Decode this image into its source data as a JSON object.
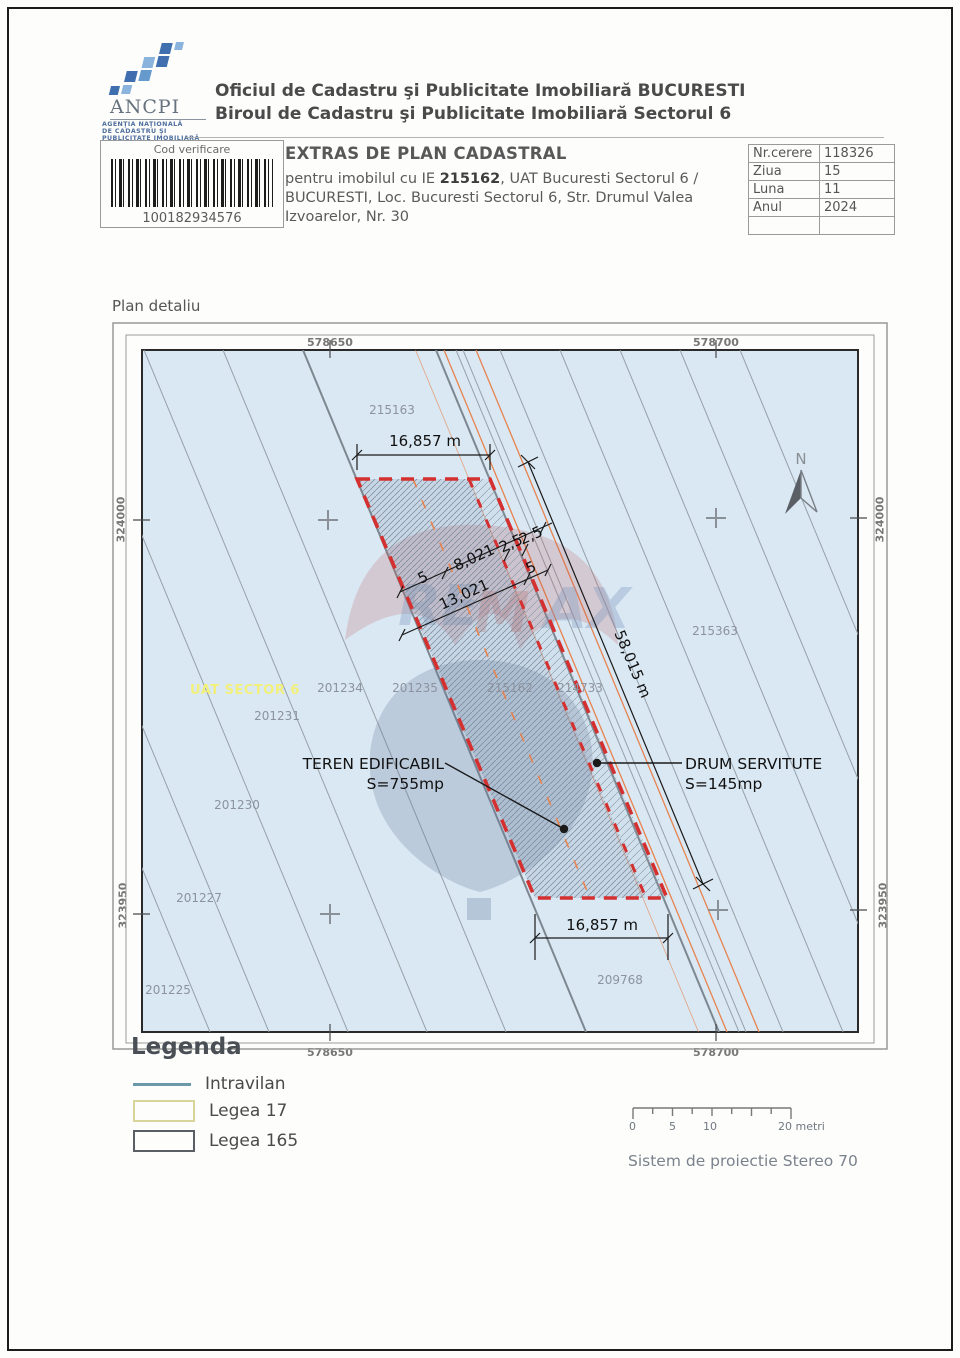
{
  "header": {
    "logo": {
      "acronym": "ANCPI",
      "sub1": "AGENŢIA NAŢIONALĂ",
      "sub2": "DE CADASTRU ŞI",
      "sub3": "PUBLICITATE IMOBILIARĂ"
    },
    "org_line1": "Oficiul de Cadastru şi Publicitate Imobiliară BUCURESTI",
    "org_line2": "Biroul de Cadastru şi Publicitate Imobiliară Sectorul 6"
  },
  "verification": {
    "label": "Cod verificare",
    "code": "100182934576"
  },
  "document": {
    "title": "EXTRAS DE PLAN CADASTRAL",
    "subject_prefix": "pentru imobilul cu IE ",
    "subject_ie": "215162",
    "subject_suffix": ", UAT Bucuresti Sectorul 6 / BUCURESTI, Loc. Bucuresti Sectorul 6, Str. Drumul Valea Izvoarelor, Nr. 30"
  },
  "request": {
    "rows": [
      {
        "label": "Nr.cerere",
        "value": "118326"
      },
      {
        "label": "Ziua",
        "value": "15"
      },
      {
        "label": "Luna",
        "value": "11"
      },
      {
        "label": "Anul",
        "value": "2024"
      }
    ]
  },
  "map": {
    "section_title": "Plan detaliu",
    "north_label": "N",
    "grid": {
      "top": [
        "578650",
        "578700"
      ],
      "bottom": [
        "578650",
        "578700"
      ],
      "left": [
        "324000",
        "323950"
      ],
      "right": [
        "324000",
        "323950"
      ]
    },
    "parcels": {
      "p215163": "215163",
      "p215363": "215363",
      "p201234": "201234",
      "p201235": "201235",
      "p215162": "215162",
      "p214733": "214733",
      "p201231": "201231",
      "p201230": "201230",
      "p201227": "201227",
      "p201225": "201225",
      "p209768": "209768",
      "uat_label": "UAT SECTOR 6"
    },
    "dimensions": {
      "top_width": "16,857 m",
      "bottom_width": "16,857 m",
      "length": "58,015 m",
      "seg_5a": "5",
      "seg_8021": "8,021",
      "seg_25a": "2,5",
      "seg_25b": "2,5",
      "seg_13021": "13,021",
      "seg_5b": "5"
    },
    "annotations": {
      "teren_line1": "TEREN EDIFICABIL",
      "teren_line2": "S=755mp",
      "drum_line1": "DRUM SERVITUTE",
      "drum_line2": "S=145mp"
    }
  },
  "legend": {
    "title": "Legenda",
    "items": [
      {
        "label": "Intravilan",
        "swatch": "line",
        "color": "#6b99aa"
      },
      {
        "label": "Legea 17",
        "swatch": "rect",
        "color": "#d8d49a"
      },
      {
        "label": "Legea 165",
        "swatch": "rect",
        "color": "#5a5f66"
      }
    ]
  },
  "scalebar": {
    "labels": [
      "0",
      "5",
      "10",
      "20 metri"
    ]
  },
  "projection": "Sistem de proiectie Stereo 70",
  "colors": {
    "map_background": "#d9e8f3",
    "parcel_outline_red": "#d43030",
    "road_line_orange": "#e8834e",
    "uat_label_yellow": "#f2ef7a",
    "boundary_gray": "#98a0a8",
    "watermark_red": "rgba(190,80,80,0.22)",
    "watermark_blue": "rgba(100,120,155,0.28)"
  }
}
